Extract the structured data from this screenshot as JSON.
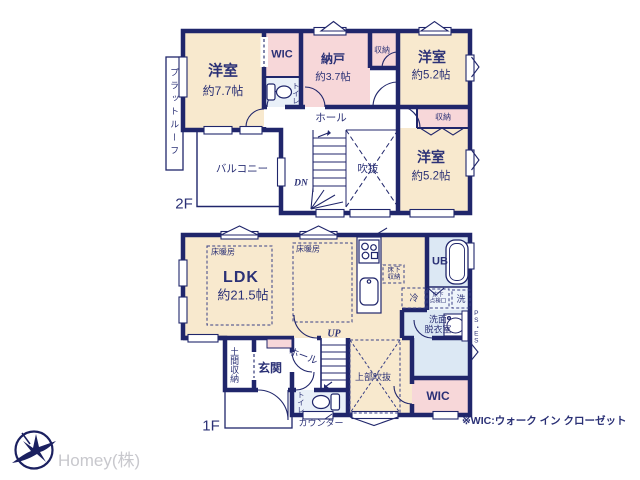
{
  "colors": {
    "wall_navy": "#20266b",
    "text_navy": "#2b3176",
    "room_peach": "#f8e9ce",
    "room_pink": "#f7d7d9",
    "room_blue": "#dce8f4",
    "room_blue_light": "#e9f0f8",
    "logo_navy": "#1b2060",
    "company_gray": "#c8c8cd"
  },
  "floor2": {
    "label": "2F",
    "rooms": {
      "bedroom_77": {
        "name": "洋室",
        "size": "約7.7帖"
      },
      "wic": {
        "label": "WIC"
      },
      "toilet": {
        "label": "トイレ"
      },
      "storage_room": {
        "name": "納戸",
        "size": "約3.7帖"
      },
      "closet_top": {
        "label": "収納"
      },
      "bedroom_52_top": {
        "name": "洋室",
        "size": "約5.2帖"
      },
      "closet_side": {
        "label": "収納"
      },
      "bedroom_52_bottom": {
        "name": "洋室",
        "size": "約5.2帖"
      },
      "hall": {
        "label": "ホール"
      },
      "void": {
        "label": "吹抜"
      },
      "balcony": {
        "label": "バルコニー"
      },
      "flat_roof": {
        "label": "プラットルーフ"
      },
      "stairs_down": {
        "label": "DN"
      }
    }
  },
  "floor1": {
    "label": "1F",
    "rooms": {
      "ldk": {
        "name": "LDK",
        "size": "約21.5帖"
      },
      "floor_heating_left": {
        "label": "床暖房"
      },
      "floor_heating_right": {
        "label": "床暖房"
      },
      "underfloor_storage": {
        "line1": "床下",
        "line2": "収納"
      },
      "refrigerator": {
        "label": "冷"
      },
      "unit_bath": {
        "label": "UB"
      },
      "washer": {
        "label": "洗"
      },
      "underfloor_hatch": {
        "line1": "床下",
        "line2": "点検口"
      },
      "washroom": {
        "line1": "洗面",
        "line2": "脱衣室"
      },
      "pipe_space": {
        "label": "PS・ES"
      },
      "doma_storage": {
        "label": "土間収納"
      },
      "entrance": {
        "label": "玄関"
      },
      "hall": {
        "label": "ホール"
      },
      "stairs_up": {
        "label": "UP"
      },
      "upper_void": {
        "label": "上部吹抜"
      },
      "toilet": {
        "label": "トイレ"
      },
      "counter": {
        "label": "カウンター"
      },
      "wic": {
        "label": "WIC"
      }
    }
  },
  "footer": {
    "note": "※WIC:ウォーク イン クローゼット",
    "company": "Homey(株)"
  }
}
